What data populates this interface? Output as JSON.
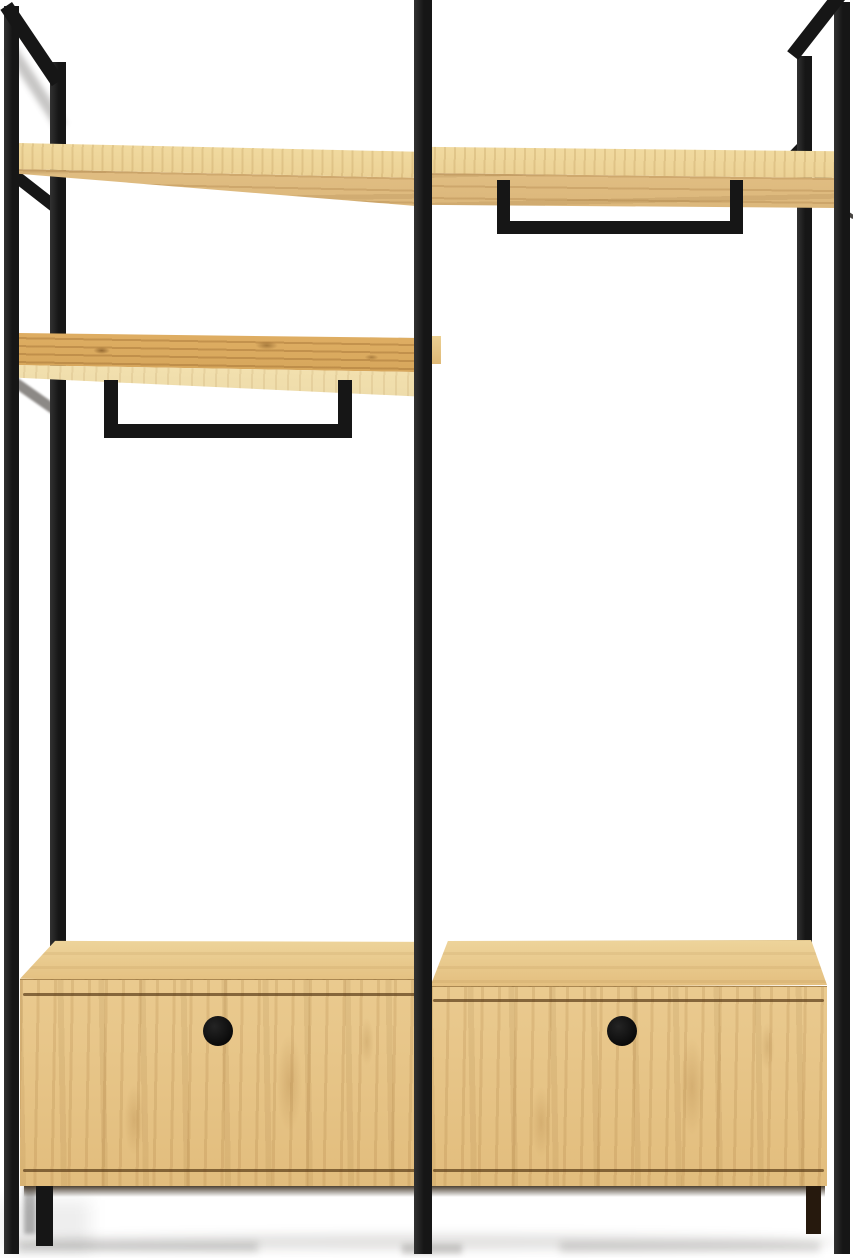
{
  "meta": {
    "subject": "Product photograph of an industrial-style open wardrobe: black square-tube metal frame with two bays, oak top shelf across both bays, middle oak shelf on the left bay, two black hanging rails, and two oak drawer cabinets with round cutout handles, on a plain white background",
    "background": "#ffffff"
  },
  "colors": {
    "bg": "#ffffff",
    "metal": "#161616",
    "metal-hi": "#323232",
    "wood-light": "#f2dca2",
    "wood-face": "#e0bd82",
    "wood-face-dark": "#d2aa6b",
    "wood-rich": "#dfae63",
    "wood-pale": "#f2e0ae",
    "wood-box": "#e3be7e",
    "wood-box-top": "#eed59c",
    "groove": "#5a3c18",
    "handle": "#0a0a0a",
    "shadow-floor": "rgba(25,20,12,.12)"
  },
  "parts": {
    "frame": {
      "posts": [
        "left-back",
        "left-front",
        "center",
        "right-front",
        "right-back"
      ],
      "top_rails": [
        "left-side",
        "right-side"
      ],
      "shelf_supports": [
        "left-top",
        "left-middle",
        "right-top"
      ]
    },
    "shelves": [
      {
        "name": "top-shelf-left-section",
        "material": "oak"
      },
      {
        "name": "top-shelf-right-section",
        "material": "oak"
      },
      {
        "name": "middle-shelf-left-section",
        "material": "oak"
      }
    ],
    "hanging_rails": [
      {
        "name": "hanging-rail-right-section",
        "shape": "U-bar under top shelf"
      },
      {
        "name": "hanging-rail-left-section",
        "shape": "U-bar under middle shelf"
      }
    ],
    "drawer_cabinets": [
      {
        "name": "drawer-cabinet-left",
        "handle": "round-cutout"
      },
      {
        "name": "drawer-cabinet-right",
        "handle": "round-cutout"
      }
    ]
  }
}
